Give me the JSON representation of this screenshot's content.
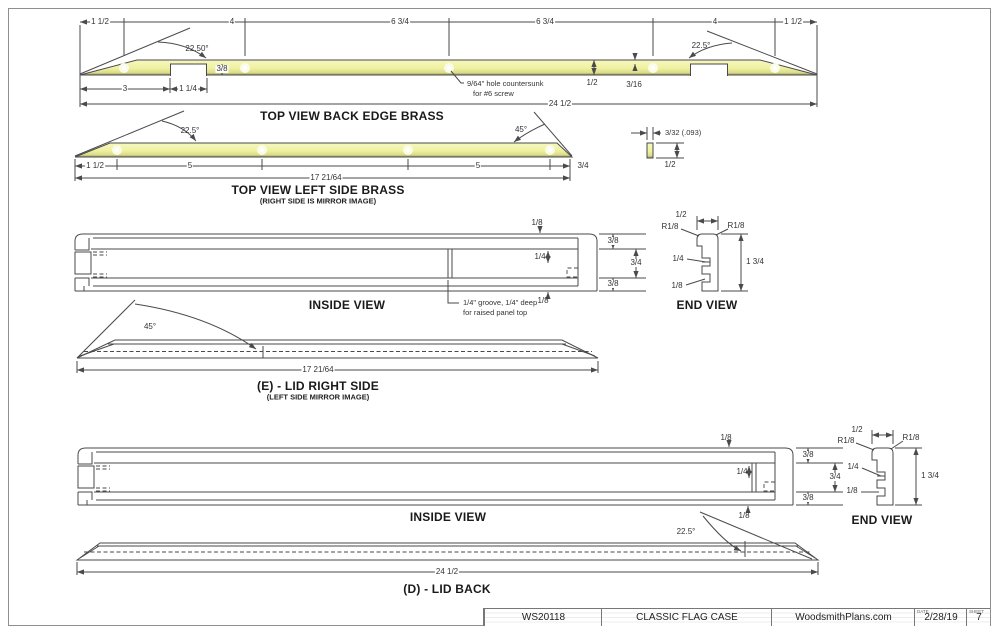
{
  "colors": {
    "brass": "#eff1a0",
    "brass_dark": "#8f905a",
    "line": "#4a4a4a",
    "text": "#333333"
  },
  "back_edge_brass": {
    "title": "TOP VIEW BACK EDGE BRASS",
    "dims_top": [
      "1 1/2",
      "4",
      "6 3/4",
      "6 3/4",
      "4",
      "1 1/2"
    ],
    "angle_left": "22.50°",
    "angle_right": "22.5°",
    "notch_depth": "3/8",
    "lip": "3",
    "notch_width": "1 1/4",
    "overall": "24 1/2",
    "strip_width": "1/2",
    "notch_remain": "3/16",
    "hole_note_1": "9/64\" hole countersunk",
    "hole_note_2": "for #6 screw"
  },
  "left_side_brass": {
    "title": "TOP VIEW LEFT SIDE BRASS",
    "subtitle": "(RIGHT SIDE IS MIRROR IMAGE)",
    "angle_left": "22.5°",
    "angle_right": "45°",
    "dims": [
      "1 1/2",
      "5",
      "5",
      "3/4"
    ],
    "overall": "17 21/64",
    "thickness": "3/32 (.093)",
    "height": "1/2"
  },
  "lid_side": {
    "inside_title": "INSIDE VIEW",
    "top_overhang": "1/8",
    "rail_top": "3/8",
    "groove_offset": "1/4",
    "panel_space": "3/4",
    "rail_bottom": "3/8",
    "bottom_overhang": "1/8",
    "groove_note_1": "1/4\" groove, 1/4\" deep",
    "groove_note_2": "for raised panel top",
    "end": {
      "title": "END VIEW",
      "width": "1/2",
      "radius_left": "R1/8",
      "radius_right": "R1/8",
      "groove": "1/4",
      "lip": "1/8",
      "height": "1 3/4"
    },
    "profile": {
      "angle": "45°",
      "overall": "17 21/64",
      "title": "(E) - LID RIGHT SIDE",
      "subtitle": "(LEFT SIDE MIRROR IMAGE)"
    }
  },
  "lid_back": {
    "inside_title": "INSIDE VIEW",
    "top_overhang": "1/8",
    "rail_top": "3/8",
    "groove_offset": "1/4",
    "panel_space": "3/4",
    "rail_bottom": "3/8",
    "bottom_overhang": "1/8",
    "end": {
      "title": "END VIEW",
      "width": "1/2",
      "radius_left": "R1/8",
      "radius_right": "R1/8",
      "groove": "1/4",
      "lip": "1/8",
      "height": "1 3/4"
    },
    "profile": {
      "angle": "22.5°",
      "overall": "24 1/2",
      "title": "(D) - LID BACK"
    }
  },
  "title_block": {
    "code": "WS20118",
    "name": "CLASSIC FLAG CASE",
    "site": "WoodsmithPlans.com",
    "date_label": "DATE",
    "date": "2/28/19",
    "sheet_label": "SHEET",
    "sheet": "7"
  }
}
